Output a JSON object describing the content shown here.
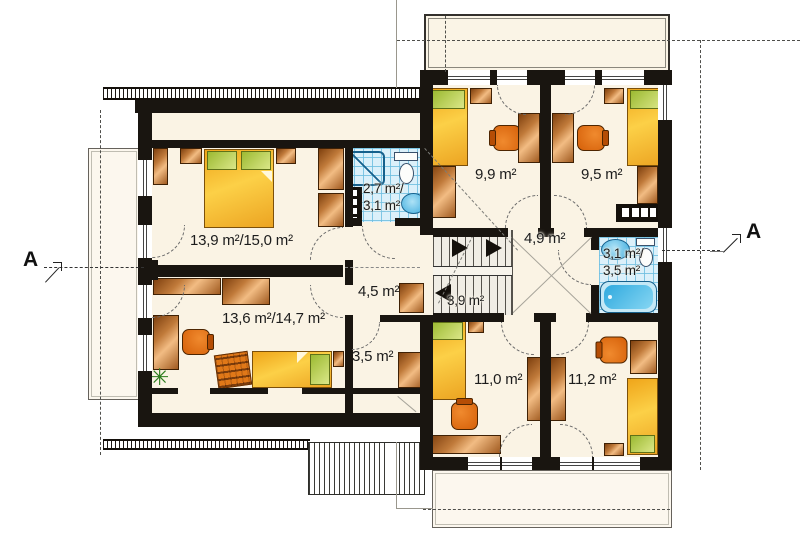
{
  "plan": {
    "type": "floor-plan",
    "section_markers": {
      "left": "A",
      "right": "A"
    },
    "rooms": [
      {
        "id": "bedroom-west-upper",
        "area_label": "13,9 m²/15,0 m²"
      },
      {
        "id": "bedroom-west-lower",
        "area_label": "13,6 m²/14,7 m²"
      },
      {
        "id": "bathroom-west",
        "area_label_line1": "2,7 m²/",
        "area_label_line2": "3,1 m²"
      },
      {
        "id": "hall-west",
        "area_label": "4,5 m²"
      },
      {
        "id": "closet-west",
        "area_label": "3,5 m²"
      },
      {
        "id": "staircase",
        "area_label": "3,9 m²"
      },
      {
        "id": "landing-east",
        "area_label": "4,9 m²"
      },
      {
        "id": "bedroom-north-left",
        "area_label": "9,9 m²"
      },
      {
        "id": "bedroom-north-right",
        "area_label": "9,5 m²"
      },
      {
        "id": "bathroom-east",
        "area_label_line1": "3,1 m²/",
        "area_label_line2": "3,5 m²"
      },
      {
        "id": "bedroom-south-left",
        "area_label": "11,0 m²"
      },
      {
        "id": "bedroom-south-right",
        "area_label": "11,2 m²"
      }
    ],
    "colors": {
      "wall": "#191510",
      "floor": "#faf3e4",
      "bathroom_tile": "#dbf0fa",
      "wood": "#c07a3a",
      "bed": "#f7bb31",
      "pillow": "#c3d25c",
      "chair": "#e06f15",
      "fixture_blue": "#45b5e6"
    }
  }
}
